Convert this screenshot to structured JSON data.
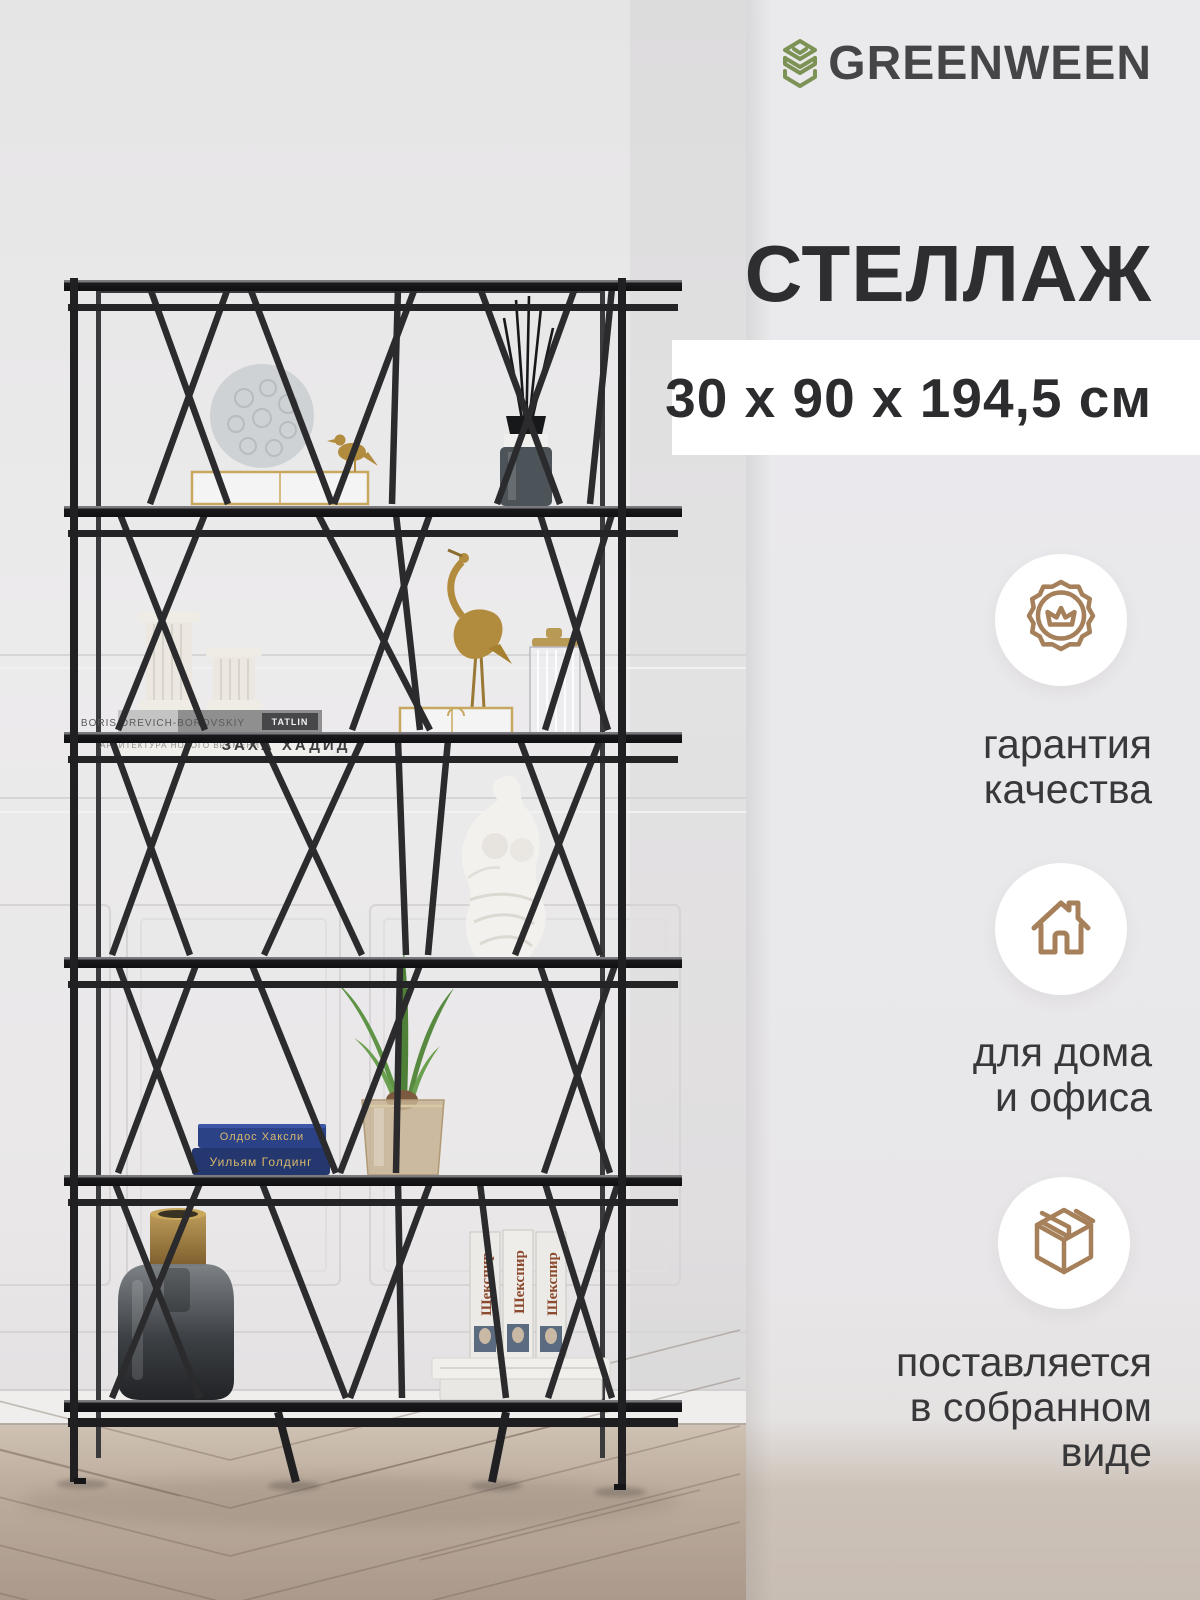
{
  "brand": {
    "name": "GREENWEEN",
    "logo_green": "#7d9355",
    "logo_text_color": "#454547"
  },
  "product": {
    "title": "СТЕЛЛАЖ",
    "dimensions": "30 x 90 x 194,5 см"
  },
  "features": [
    {
      "icon": "medal-crown-icon",
      "lines": [
        "гарантия",
        "качества"
      ]
    },
    {
      "icon": "house-icon",
      "lines": [
        "для дома",
        "и офиса"
      ]
    },
    {
      "icon": "package-box-icon",
      "lines": [
        "поставляется",
        "в собранном",
        "виде"
      ]
    }
  ],
  "accent_colors": {
    "icon_bronze": "#a5805a",
    "panel_bg": "#e9e8ea",
    "dims_box_bg": "#ffffff"
  },
  "photo": {
    "books": {
      "architect_top": "BORIS DREVICH-BOROVSKIY",
      "architect_publisher": "TATLIN",
      "architect_series": "АРХИТЕКТУРА НОВОГО ВРЕМЕНИ",
      "architect_title": "ЗАХА ХАДИД",
      "blue_top": "Олдос Хаксли",
      "blue_bottom": "Уильям Голдинг",
      "shakespeare": "Шекспир"
    }
  }
}
